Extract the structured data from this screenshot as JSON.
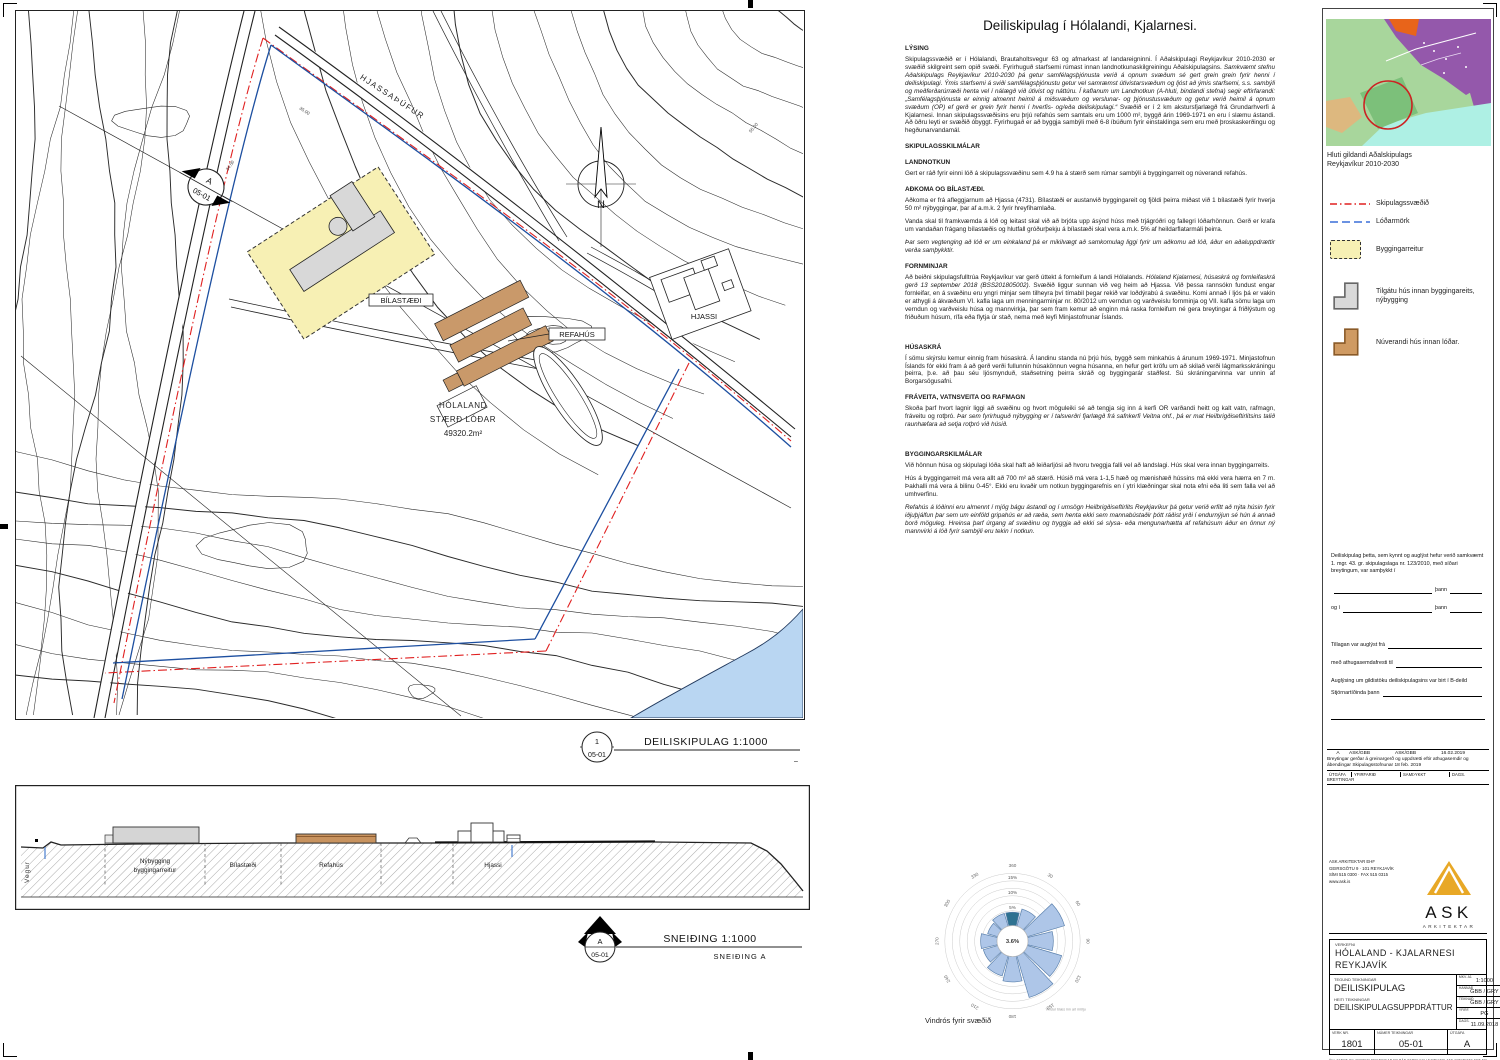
{
  "title": "Deiliskipulag í Hólalandi, Kjalarnesi.",
  "map": {
    "labels": {
      "hjassathufur": "HJASSAÞÚFUR",
      "bilastaedi": "BÍLASTÆÐI",
      "refahus": "REFAHÚS",
      "hjassi": "HJASSI",
      "holaland1": "HÓLALAND",
      "holaland2": "STÆRÐ LÓÐAR",
      "holaland3": "49320.2m²",
      "north": "N",
      "elev1": "35.00",
      "elev2": "34.50",
      "elev3": "55.00"
    },
    "marker": {
      "top": "A",
      "bottom": "05-01"
    }
  },
  "plan_scale": {
    "num": "1",
    "sheet": "05-01",
    "label": "DEILISKIPULAG 1:1000",
    "dash": "–"
  },
  "section_scale": {
    "num": "A",
    "sheet": "05-01",
    "label": "SNEIÐING 1:1000",
    "sub": "SNEIÐING A"
  },
  "section_drawing": {
    "vegur": "Vegur",
    "nybygging1": "Nýbygging",
    "nybygging2": "byggingarreitur",
    "bilastaedi": "Bílastæði",
    "refahus": "Refahús",
    "hjassi": "Hjassi"
  },
  "sections": [
    {
      "h": "LÝSING"
    },
    {
      "p": [
        {
          "t": "Skipulagssvæðið er í Hólalandi, Brautaholtsvegur 63 og afmarkast af landareigninni. Í Aðalskipulagi Reykjavíkur 2010-2030 er svæðið skilgreint sem opið svæði. Fyrirhuguð starfsemi rúmast innan landnotkunaskilgreiningu Aðalskipulagsins. ",
          "i": false
        },
        {
          "t": "Samkvæmt stefnu Aðalskipulags Reykjavíkur 2010-2030 þá getur samfélagsþjónusta verið á opnum svæðum sé gert grein grein fyrir henni í deiliskipulagi. Ýmis starfsemi á sviði samfélagsþjónustu getur vel samræmst útivistarsvæðum og ljóst að ýmis starfsemi, s.s. sambýli og meðferðarúrræði henta vel í nálægð við útivist og náttúru. Í kaflanum um Landnotkun (A-hluti, bindandi stefna) segir eftirfarandi: „Samfélagsþjónusta er einnig almennt heimil á miðsvæðum og verslunar- og þjónustusvæðum og getur verið heimil á opnum svæðum (OP) ef gerð er grein fyrir henni í hverfis- og/eða deiliskipulagi.“ ",
          "i": true
        },
        {
          "t": "Svæðið er í 2 km akstursfjarlægð frá Grundarhverfi á Kjalarnesi. Innan skipulagssvæðisins eru þrjú refahús sem samtals eru um 1000 m², byggð árin 1969-1971 en eru í slæmu ástandi. Að öðru leyti er svæðið óbyggt. Fyrirhugað er að byggja sambýli með 6-8 íbúðum fyrir einstaklinga sem eru með þroskaskerðingu og hegðunarvandamál.",
          "i": false
        }
      ]
    },
    {
      "h": "SKIPULAGSSKILMÁLAR"
    },
    {
      "h": "LANDNOTKUN"
    },
    {
      "p": [
        {
          "t": "Gert er ráð fyrir einni lóð á skipulagssvæðinu sem 4.9 ha á stærð sem rúmar sambýli á byggingarreit og núverandi refahús.",
          "i": false
        }
      ]
    },
    {
      "h": "AÐKOMA OG BÍLASTÆÐI."
    },
    {
      "p": [
        {
          "t": "Aðkoma er frá afleggjarnum að Hjassa (4731). Bílastæði er austanvið byggingareit og fjöldi þeirra miðast við 1 bílastæði fyrir hverja 50 m² nýbyggingar, þar af a.m.k. 2 fyrir hreyfihamlaða.",
          "i": false
        }
      ]
    },
    {
      "p": [
        {
          "t": "Vanda skal til framkvæmda á lóð og leitast skal við að brjóta upp ásýnd húss með trjágróðri og fallegri lóðarhönnun. Gerð er krafa um vandaðan frágang bílastæðis og hlutfall gróðurþekju á bílastæði skal vera a.m.k. 5% af heildarflatarmáli þeirra.",
          "i": false
        }
      ]
    },
    {
      "p": [
        {
          "t": "Þar sem vegtenging að lóð er um einkaland þá er mikilvægt að samkomulag liggi fyrir um aðkomu að lóð, áður en aðaluppdrættir verða samþykktir.",
          "i": true
        }
      ]
    },
    {
      "h": "FORNMINJAR"
    },
    {
      "p": [
        {
          "t": "Að beiðni skipulagsfulltrúa Reykjavíkur var gerð úttekt á fornleifum á landi Hólalands. ",
          "i": false
        },
        {
          "t": "Hólaland Kjalarnesi, húsaskrá og fornleifaskrá gerð 13 september 2018 (BSS201805002).",
          "i": true
        },
        {
          "t": "  Svæðið liggur sunnan við veg heim að Hjassa.  Við þessa rannsókn fundust engar fornleifar, en á svæðinu eru yngri minjar sem tilheyra því tímabil þegar rekið var loðdýrabú á svæðinu. Komi annað í ljós þá er vakin er athygli á ákvæðum VI. kafla laga um menningarminjar nr. 80/2012 um verndun og varðveislu fornminja og VII. kafla sömu laga um verndun og varðveislu húsa og mannvirkja, þar sem fram kemur að enginn má raska fornleifum né gera breytingar á friðlýstum og friðuðum húsum, rífa eða flytja úr stað, nema með leyfi Minjastofnunar Íslands.",
          "i": false
        }
      ]
    },
    {
      "h": "HÚSASKRÁ",
      "extra": true
    },
    {
      "p": [
        {
          "t": "Í sömu skýrslu kemur einnig fram húsaskrá.  Á landinu standa nú þrjú hús, byggð sem minkahús á árunum 1969-1971. Minjastofnun Íslands fór ekki fram á að gerð verði fullunnin húsakönnun vegna húsanna, en hefur gert kröfu um að skilað verði lágmarksskráningu þeirra, þ.e. að þau séu ljósmynduð, staðsetning þeirra skráð og byggingarár staðfest. Sú skráningarvinna var unnin af Borgarsögusafni.",
          "i": false
        }
      ]
    },
    {
      "h": "FRÁVEITA, VATNSVEITA OG RAFMAGN"
    },
    {
      "p": [
        {
          "t": "Skoða þarf hvort lagnir liggi að svæðinu og hvort möguleiki sé að tengja sig inn á kerfi OR varðandi heitt og kalt vatn, rafmagn, fráveitu og rotþró. ",
          "i": false
        },
        {
          "t": "Þar sem fyrirhuguð nýbygging er í talsverðri fjarlægð frá safnkerfi Veitna ohf., þá er mat Heilbrigðiseftirlitsins talið raunhæfara að setja rotþró við húsið.",
          "i": true
        }
      ]
    },
    {
      "h": "BYGGINGARSKILMÁLAR",
      "extra": true
    },
    {
      "p": [
        {
          "t": "Við hönnun húsa og skipulagi lóða skal haft að leiðarljósi að hvoru tveggja falli vel að landslagi. Hús skal vera innan byggingarreits.",
          "i": false
        }
      ]
    },
    {
      "p": [
        {
          "t": "Hús á byggingarreit má vera allt að 700 m² að stærð. Húsið má vera 1-1,5 hæð og mænishæð hússins má ekki vera hærra en 7 m. Þakhalli má vera á bilinu 0-45°. Ekki eru kvaðir um notkun byggingarefnis en í ytri klæðningar skal nota efni eða liti sem falla vel að umhverfinu.",
          "i": false
        }
      ]
    },
    {
      "p": [
        {
          "t": "Refahús á lóðinni eru almennt í mjög bágu ástandi og í umsögn Heilbrigðiseftirlits Reykjavíkur þá getur verið erfitt að nýta húsin fyrir iðjuþjálfun þar sem um einföld gripahús er að ræða, sem henta ekki sem mannabústaðir þótt ráðist yrði í endurnýjun sé hún á annað borð möguleg. Hreinsa þarf úrgang af svæðinu og tryggja að ekki sé slysa- eða mengunarhætta af refahúsum áður en önnur ný mannvirki á lóð fyrir sambýli eru tekin í notkun.",
          "i": true
        }
      ]
    }
  ],
  "chart_data": {
    "type": "bar",
    "polar": true,
    "title": "Vindrós fyrir svæðið",
    "note": "Vindur blæs inn að miðju",
    "center_label": "3.6%",
    "ring_percent": [
      5,
      10,
      15
    ],
    "ring_labels": [
      "5%",
      "10%",
      "15%"
    ],
    "max_percent": 17.5,
    "directions_deg": [
      30,
      60,
      90,
      120,
      150,
      180,
      210,
      240,
      270,
      300,
      330,
      360
    ],
    "dir_labels": [
      "30",
      "60",
      "90",
      "120",
      "150",
      "180",
      "210",
      "240",
      "270",
      "300",
      "330",
      "360"
    ],
    "values_percent": [
      6,
      13,
      8.5,
      12,
      14.5,
      8.5,
      7,
      5,
      5.5,
      3.5,
      4.5,
      4.5
    ],
    "highlight_dir": 360,
    "colors": {
      "petal": "#aec6e8",
      "petal_stroke": "#5b81ad",
      "highlight": "#2e7190"
    }
  },
  "right_panel": {
    "inset_caption1": "Hluti gildandi Aðalskipulags",
    "inset_caption2": "Reykjavíkur 2010-2030",
    "legend": [
      {
        "icon": "red-dashdot-line",
        "label": "Skipulagssvæðið"
      },
      {
        "icon": "blue-dashed-line",
        "label": "Lóðarmörk"
      },
      {
        "icon": "yellow-dashed-rect",
        "label": "Byggingarreitur"
      },
      {
        "icon": "gray-house",
        "label": "Tilgátu hús innan byggingareits, nýbygging"
      },
      {
        "icon": "orange-house",
        "label": "Núverandi hús innan lóðar."
      }
    ],
    "approval": {
      "intro": "Deiliskipulag þetta, sem kynnt og auglýst hefur verið samkvæmt 1. mgr. 43. gr. skipulagslaga nr. 123/2010, með síðari breytingum, var samþykkt í",
      "thann1": "þann",
      "og_i": "og í",
      "thann2": "þann",
      "auglyst": "Tillagan var auglýst frá",
      "frestur": "með athugasemdafresti til",
      "gildistoku": "Auglýsing um gildistöku deiliskipulagsins var birt í B-deild",
      "stjornartidindi": "Stjórnartíðinda þann"
    },
    "revisions": {
      "row": [
        "A",
        "ASK/GBB",
        "ASK/GBB",
        "16.02.2019"
      ],
      "desc": "Breytingar gerðar á greinargerð og uppdrætti eftir athugasemdir og ábendingar Skipulagsstofnunar 18 feb. 2019",
      "headers": [
        "ÚTGÁFA",
        "YFIRFARIÐ",
        "SAMÞYKKT",
        "DAGS."
      ],
      "breytingar": "BREYTINGAR"
    },
    "firm": {
      "name": "ASK ARKITEKTAR EHF",
      "address": "GEIRSGÖTU 9 · 101 REYKJAVÍK",
      "phone": "SÍMI 515 0300 · FAX 515 0315",
      "web": "www.ask.is",
      "logo_text": "ASK",
      "logo_sub": "ARKITEKTAR"
    },
    "titleblock": {
      "verkefni_label": "VERKEFNI",
      "project1": "HÓLALAND - KJALARNESI",
      "project2": "REYKJAVÍK",
      "tegund_label": "TEGUND TEIKNINGAR",
      "tegund": "DEILISKIPULAG",
      "heiti_label": "HEITI TEIKNINGAR",
      "heiti": "DEILISKIPULAGSUPPDRÁTTUR",
      "fields": [
        {
          "l": "MKV. A1",
          "v": "1:1000"
        },
        {
          "l": "HANNAÐ",
          "v": "GBB / GRY"
        },
        {
          "l": "TEIKNAÐ",
          "v": "GBB / GRY"
        },
        {
          "l": "YFIRF.",
          "v": "PG"
        },
        {
          "l": "DAGS.",
          "v": "11.09.2018"
        }
      ],
      "verknr_label": "VERK NR.",
      "verknr": "1801",
      "teikning_label": "NÚMER TEIKNINGAR",
      "teikning": "05-01",
      "utgafa_label": "ÚTGÁFA",
      "utgafa": "A",
      "fineprint": "ÖLL AFNOT OG AFRITUN TEIKNINGAR ER HÁÐ SKRIFLEGU SAMÞYKKI ASK ARKITEKTA EHF SEM EIGA HÖFUNDARRÉTT AÐ TEIKNINGUNNI"
    }
  }
}
